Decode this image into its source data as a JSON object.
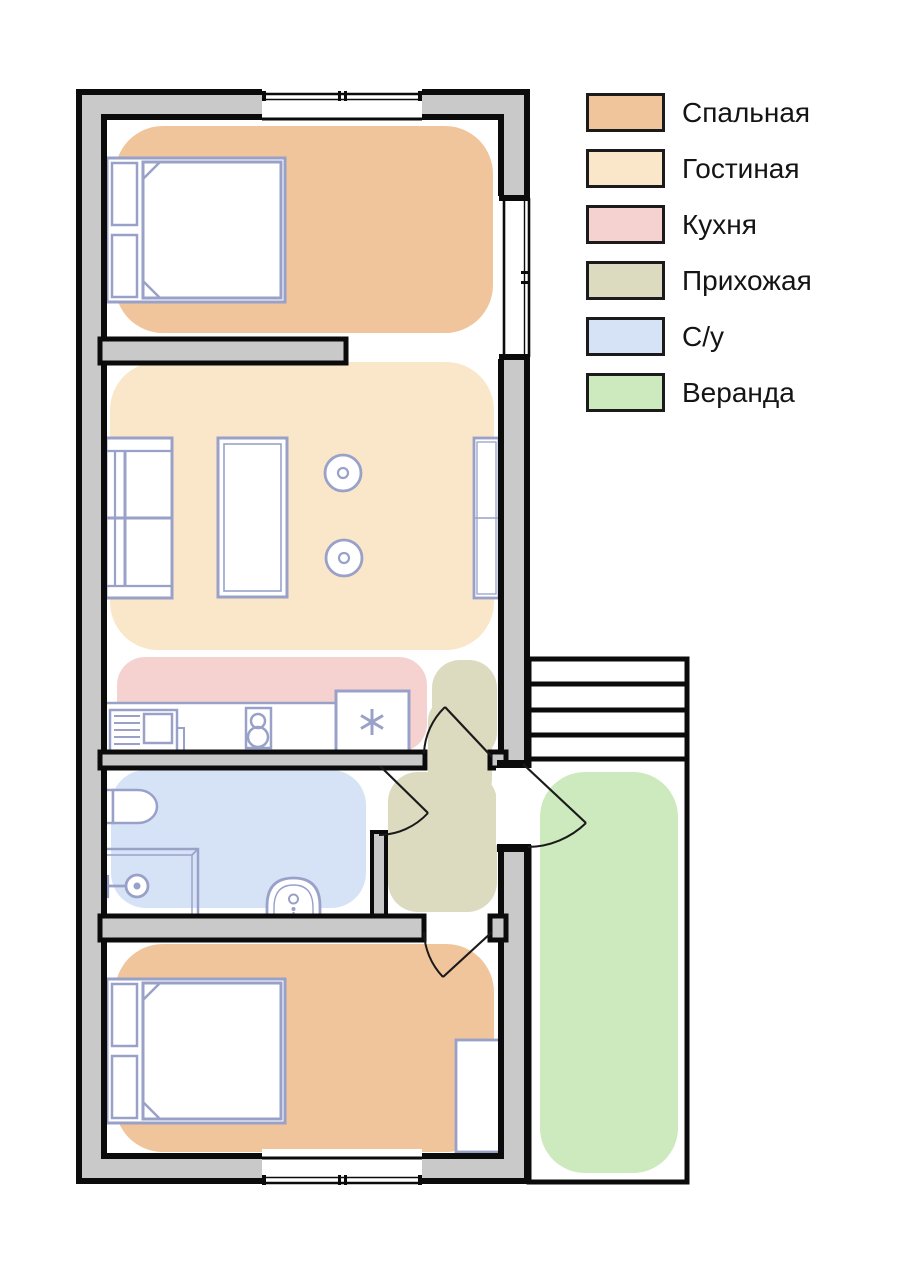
{
  "legend": {
    "items": [
      {
        "label": "Спальная",
        "color": "#f1c59c"
      },
      {
        "label": "Гостиная",
        "color": "#fae7ca"
      },
      {
        "label": "Кухня",
        "color": "#f5d2cf"
      },
      {
        "label": "Прихожая",
        "color": "#dcdabf"
      },
      {
        "label": "С/у",
        "color": "#d6e3f7"
      },
      {
        "label": "Веранда",
        "color": "#cdeabf"
      }
    ]
  },
  "colors": {
    "bedroom": "#f1c59c",
    "living_room": "#fae7ca",
    "kitchen": "#f5d2cf",
    "hallway": "#dcdabf",
    "bathroom": "#d6e3f7",
    "veranda": "#cdeabf",
    "wall_fill": "#c9c9c9",
    "wall_line": "#0b0b0b",
    "door_line": "#1a1a1a",
    "furniture_line": "#99a1c9"
  }
}
